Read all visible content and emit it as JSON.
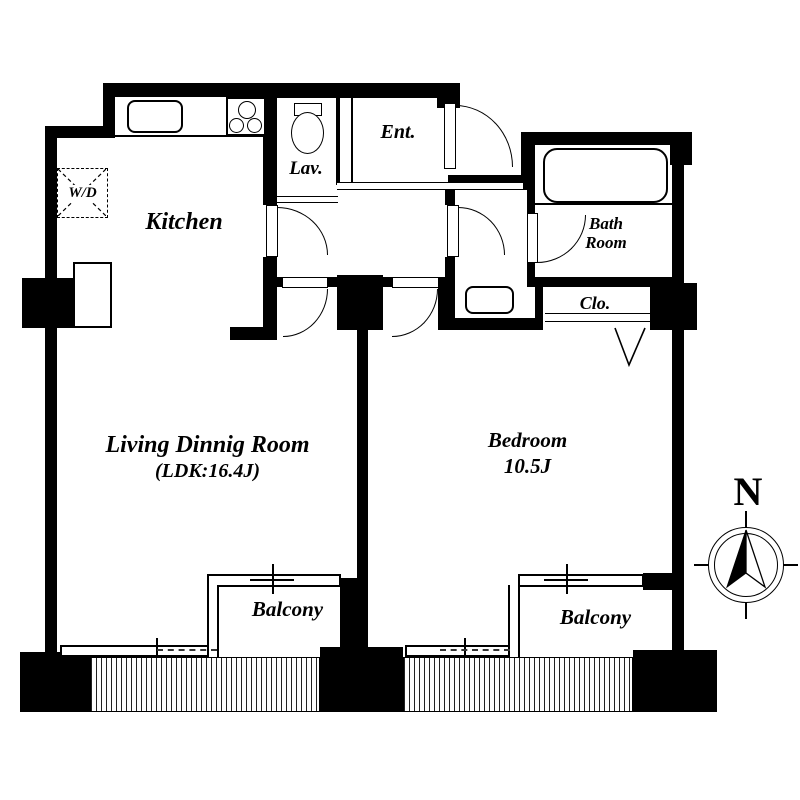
{
  "plan": {
    "type": "apartment-floor-plan",
    "rooms": {
      "kitchen": {
        "label": "Kitchen"
      },
      "living": {
        "label": "Living Dinnig Room",
        "size": "(LDK:16.4J)"
      },
      "bedroom": {
        "label": "Bedroom",
        "size": "10.5J"
      },
      "entrance": {
        "label": "Ent."
      },
      "lavatory": {
        "label": "Lav."
      },
      "bathroom": {
        "line1": "Bath",
        "line2": "Room"
      },
      "closet": {
        "label": "Clo."
      },
      "washer_dryer": {
        "label": "W/D"
      },
      "balcony_left": {
        "label": "Balcony"
      },
      "balcony_right": {
        "label": "Balcony"
      }
    },
    "compass": {
      "north_label": "N"
    },
    "colors": {
      "wall": "#000000",
      "background": "#ffffff",
      "line": "#000000"
    }
  }
}
